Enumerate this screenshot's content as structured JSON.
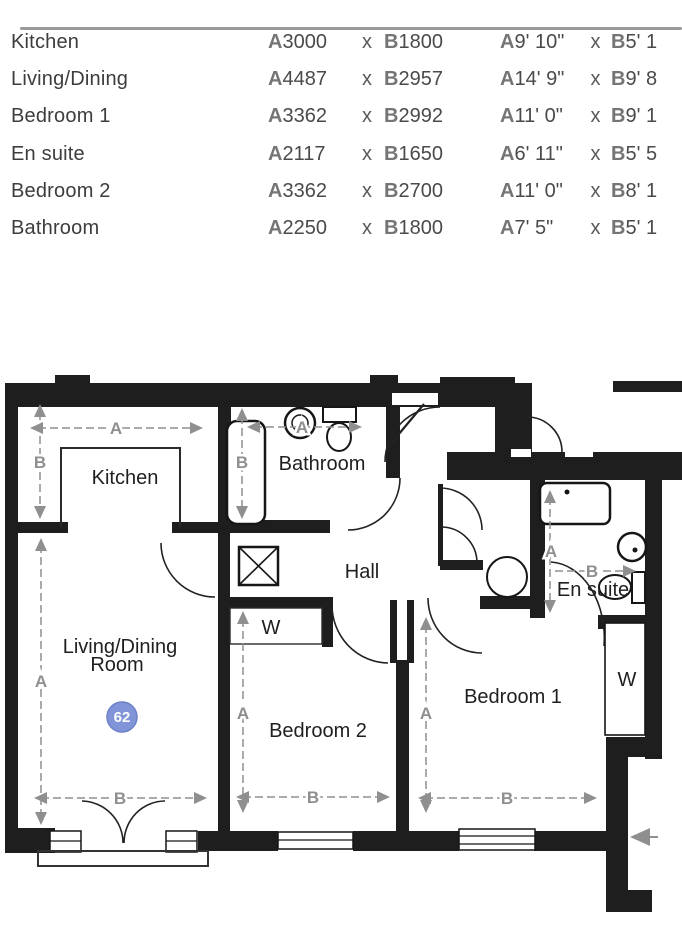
{
  "table": {
    "prefix_a": "A",
    "prefix_b": "B",
    "times": "x",
    "rows": [
      {
        "name": "Kitchen",
        "a_mm": "3000",
        "b_mm": "1800",
        "a_ft": "9' 10\"",
        "b_ft": "5' 1"
      },
      {
        "name": "Living/Dining",
        "a_mm": "4487",
        "b_mm": "2957",
        "a_ft": "14' 9\"",
        "b_ft": "9' 8"
      },
      {
        "name": "Bedroom 1",
        "a_mm": "3362",
        "b_mm": "2992",
        "a_ft": "11' 0\"",
        "b_ft": "9' 1"
      },
      {
        "name": "En suite",
        "a_mm": "2117",
        "b_mm": "1650",
        "a_ft": "6' 11\"",
        "b_ft": "5' 5"
      },
      {
        "name": "Bedroom 2",
        "a_mm": "3362",
        "b_mm": "2700",
        "a_ft": "11' 0\"",
        "b_ft": "8' 1"
      },
      {
        "name": "Bathroom",
        "a_mm": "2250",
        "b_mm": "1800",
        "a_ft": "7' 5\"",
        "b_ft": "5' 1"
      }
    ]
  },
  "plan": {
    "unit_number": "62",
    "wardrobe_label": "W",
    "dim_a": "A",
    "dim_b": "B",
    "rooms": {
      "kitchen": "Kitchen",
      "bathroom": "Bathroom",
      "hall": "Hall",
      "ensuite": "En suite",
      "living_line1": "Living/Dining",
      "living_line2": "Room",
      "bedroom1": "Bedroom 1",
      "bedroom2": "Bedroom 2"
    },
    "colors": {
      "wall": "#1e1e1e",
      "dim_gray": "#8f8f8f",
      "badge_fill": "#8194d8",
      "badge_border": "#6d82c8"
    }
  }
}
